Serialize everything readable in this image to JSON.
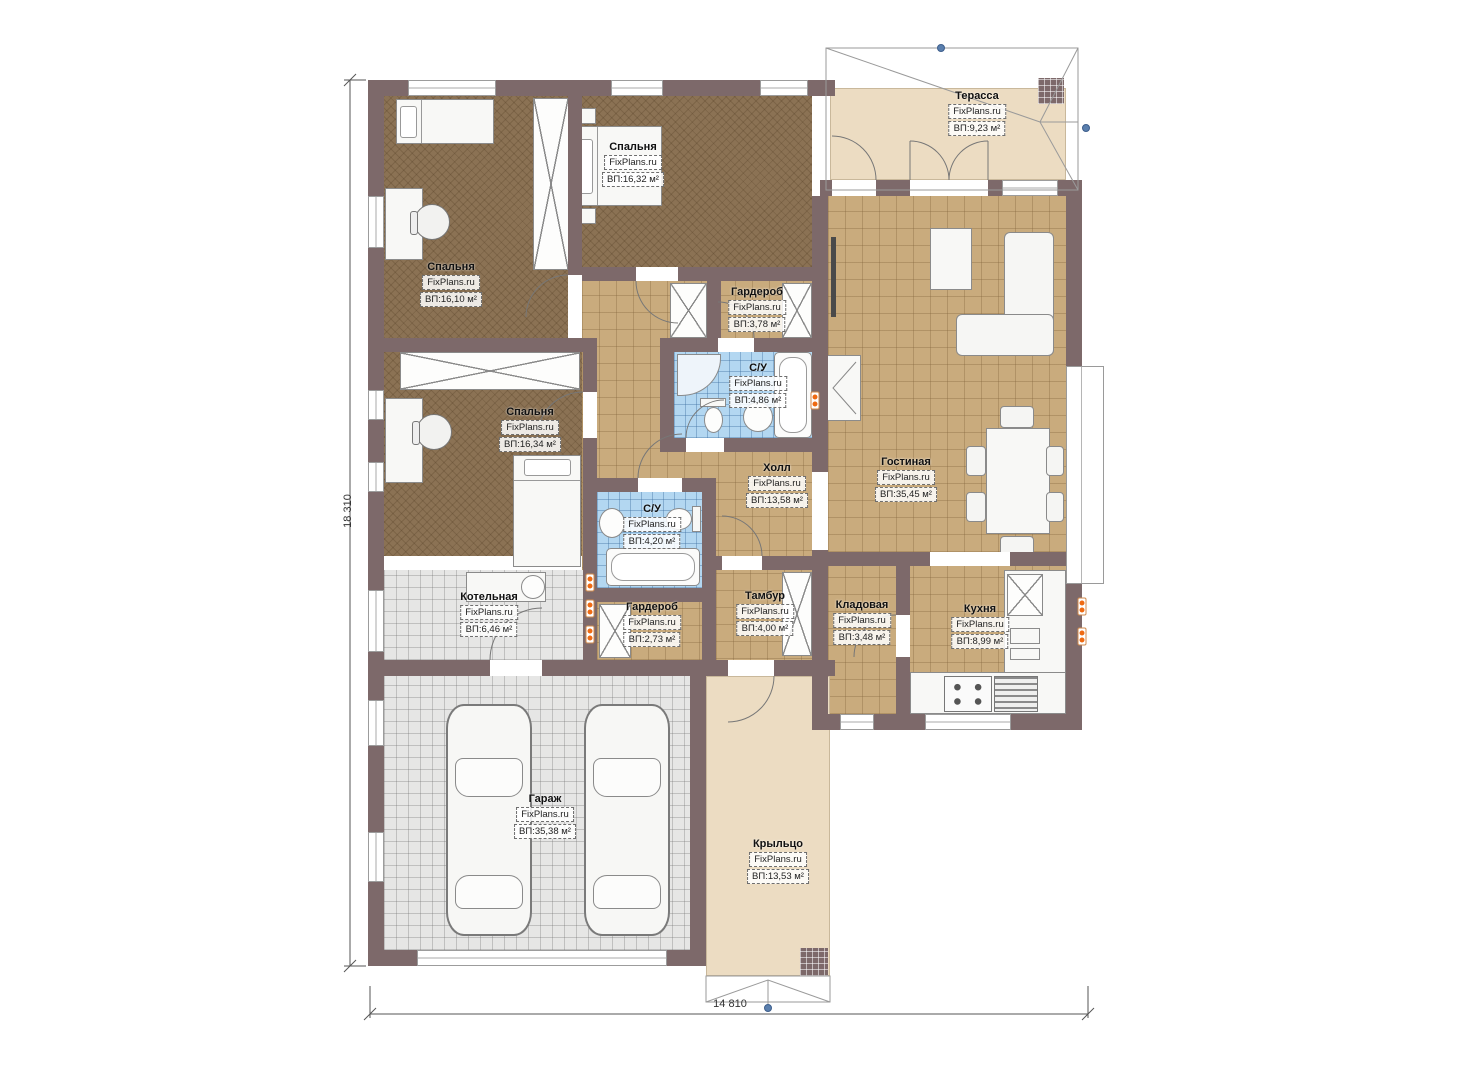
{
  "plan": {
    "brand": "FixPlans.ru",
    "type_label": "floor-plan",
    "colors": {
      "wall": "#7d696a",
      "bedroom_floor": "#8b7254",
      "tile_floor": "#c9ab7d",
      "bath_floor": "#b3d7f1",
      "tech_floor": "#e6e6e5",
      "outdoor_floor": "#ecdcc2",
      "socket": "#ef6a12",
      "marker": "#5a7fae"
    }
  },
  "dimensions": {
    "left": "18 310",
    "bottom": "14 810"
  },
  "rooms": [
    {
      "name": "Терасса",
      "brand": "FixPlans.ru",
      "area": "ВП:9,23 м²"
    },
    {
      "name": "Спальня",
      "brand": "FixPlans.ru",
      "area": "ВП:16,32 м²"
    },
    {
      "name": "Спальня",
      "brand": "FixPlans.ru",
      "area": "ВП:16,10 м²"
    },
    {
      "name": "Гардероб",
      "brand": "FixPlans.ru",
      "area": "ВП:3,78 м²"
    },
    {
      "name": "С/У",
      "brand": "FixPlans.ru",
      "area": "ВП:4,86 м²"
    },
    {
      "name": "Спальня",
      "brand": "FixPlans.ru",
      "area": "ВП:16,34 м²"
    },
    {
      "name": "Холл",
      "brand": "FixPlans.ru",
      "area": "ВП:13,58 м²"
    },
    {
      "name": "Гостиная",
      "brand": "FixPlans.ru",
      "area": "ВП:35,45 м²"
    },
    {
      "name": "С/У",
      "brand": "FixPlans.ru",
      "area": "ВП:4,20 м²"
    },
    {
      "name": "Котельная",
      "brand": "FixPlans.ru",
      "area": "ВП:6,46 м²"
    },
    {
      "name": "Гардероб",
      "brand": "FixPlans.ru",
      "area": "ВП:2,73 м²"
    },
    {
      "name": "Тамбур",
      "brand": "FixPlans.ru",
      "area": "ВП:4,00 м²"
    },
    {
      "name": "Кладовая",
      "brand": "FixPlans.ru",
      "area": "ВП:3,48 м²"
    },
    {
      "name": "Кухня",
      "brand": "FixPlans.ru",
      "area": "ВП:8,99 м²"
    },
    {
      "name": "Гараж",
      "brand": "FixPlans.ru",
      "area": "ВП:35,38 м²"
    },
    {
      "name": "Крыльцо",
      "brand": "FixPlans.ru",
      "area": "ВП:13,53 м²"
    }
  ]
}
